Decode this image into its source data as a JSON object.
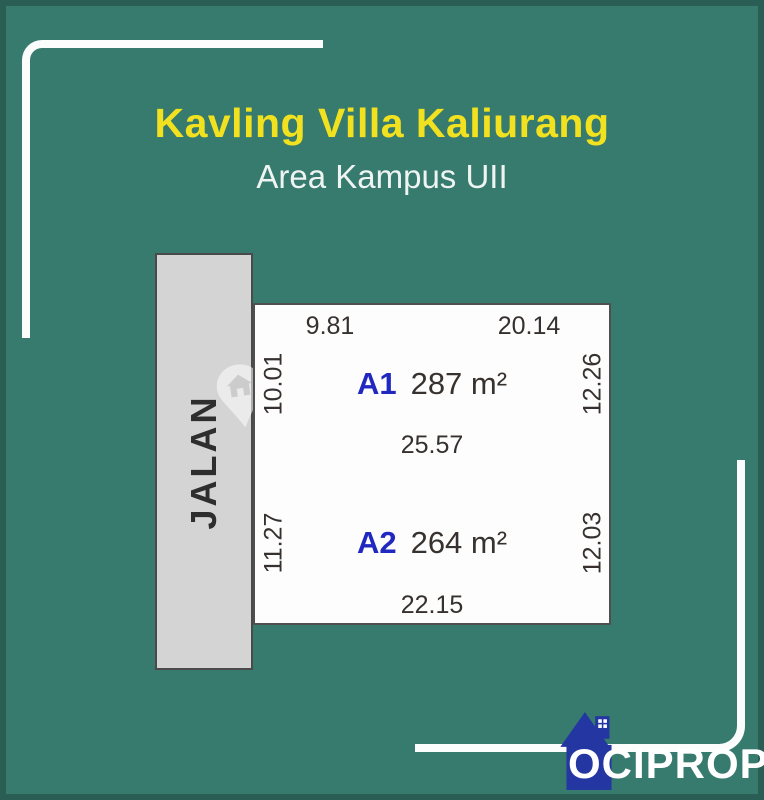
{
  "poster": {
    "title": "Kavling Villa Kaliurang",
    "subtitle": "Area Kampus UII",
    "road": {
      "label": "JALAN"
    },
    "plots": [
      {
        "id": "A1",
        "area": "287 m²",
        "dim_top_left": "9.81",
        "dim_top_right": "20.14",
        "dim_left": "10.01",
        "dim_right": "12.26",
        "dim_bottom": "25.57"
      },
      {
        "id": "A2",
        "area": "264 m²",
        "dim_left": "11.27",
        "dim_right": "12.03",
        "dim_bottom": "22.15"
      }
    ],
    "brand": {
      "name": "OCIPROP"
    },
    "colors": {
      "background": "#377a6e",
      "frame_border": "#2a5d53",
      "title": "#f2e11f",
      "subtitle": "#eef4f2",
      "road_fill": "#d4d4d4",
      "plot_fill": "#fdfdfd",
      "plot_id_accent": "#2028c0",
      "dimension_text": "#36312f",
      "deco_line": "#fafdfc",
      "logo_house": "#2336a2",
      "logo_text": "#ffffff"
    }
  }
}
